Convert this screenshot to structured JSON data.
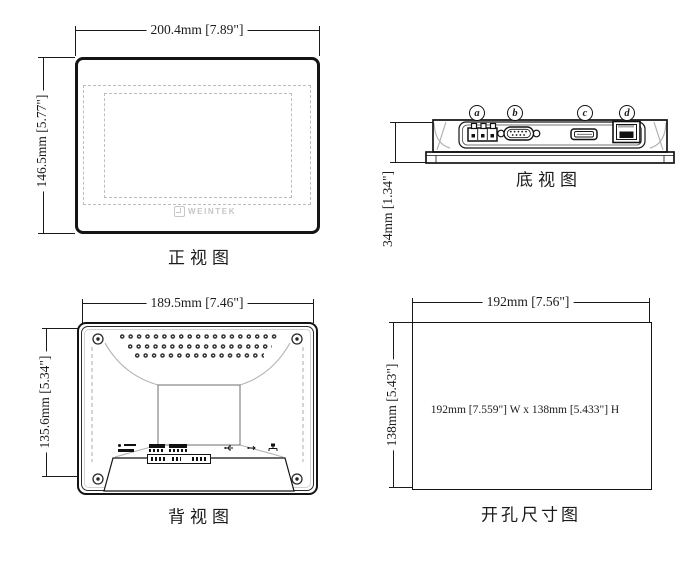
{
  "colors": {
    "line": "#1b1b1b",
    "gray_outline": "#b3b3b3",
    "logo_gray": "#c6c6c6"
  },
  "front_view": {
    "label": "正视图",
    "width_dim": "200.4mm [7.89\"]",
    "height_dim": "146.5mm [5.77\"]",
    "logo_text": "WEINTEK"
  },
  "bottom_view": {
    "label": "底视图",
    "height_dim": "34mm [1.34\"]",
    "ports": [
      {
        "letter": "a",
        "name": "power-terminal"
      },
      {
        "letter": "b",
        "name": "serial-db9-port"
      },
      {
        "letter": "c",
        "name": "usb-port"
      },
      {
        "letter": "d",
        "name": "ethernet-port"
      }
    ]
  },
  "back_view": {
    "label": "背视图",
    "width_dim": "189.5mm [7.46\"]",
    "height_dim": "135.6mm [5.34\"]"
  },
  "cutout_view": {
    "label": "开孔尺寸图",
    "width_dim": "192mm [7.56\"]",
    "height_dim": "138mm [5.43\"]",
    "center_text": "192mm [7.559\"] W x 138mm [5.433\"] H"
  }
}
